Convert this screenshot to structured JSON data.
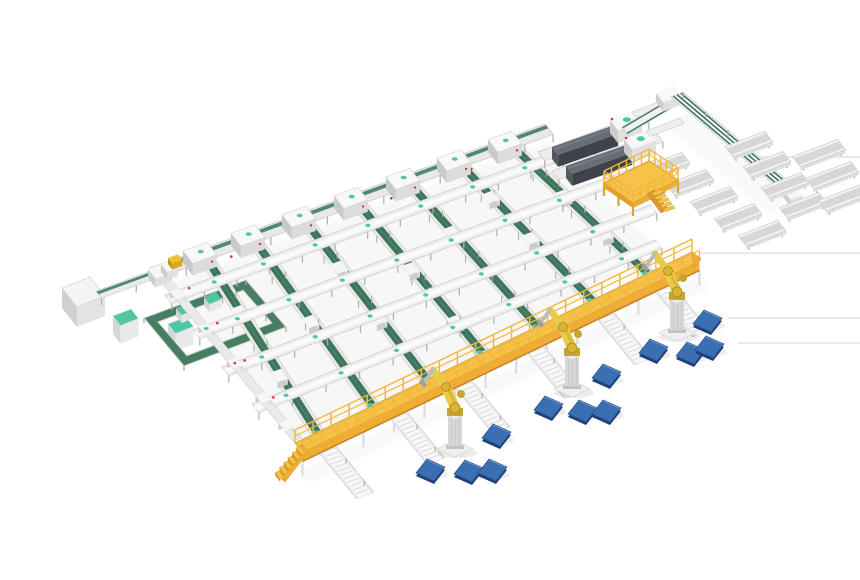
{
  "meta": {
    "alt": "Isometric 3D render of an automated parcel sorting and palletizing line on a white background"
  },
  "inventory": {
    "sorter_lanes": 7,
    "cross_conveyors": 4,
    "lane_head_units": 7,
    "tunnel_scanners": 2,
    "discharge_trays": 9,
    "stub_conveyors": 3,
    "palletizing_robots": 3,
    "pallets": 12,
    "maintenance_platforms": 1,
    "elevated_walkways": 1,
    "control_cabinets": 1,
    "tote_stations": 2,
    "loop_circuits": 1,
    "outfeed_spurs": 6
  },
  "palette": {
    "bg": "#ffffff",
    "frame": "#ececec",
    "frame_light": "#f8f8f8",
    "frame_mid": "#dadada",
    "frame_dark": "#c6c6c6",
    "leg": "#aeaeae",
    "belt": "#3c745c",
    "belt_edge": "#2f6b51",
    "belt_light": "#578f74",
    "belt_stripe": "#4e8a6e",
    "teal": "#4fc7a4",
    "loop": "#457e61",
    "deck": "#f6c24a",
    "deck_mid": "#f0ad35",
    "deck_dark": "#d89c28",
    "deck_shadow": "#c97f1f",
    "rail": "#f2b83e",
    "robot": "#e9cb49",
    "robot_dark": "#c7a52e",
    "pedestal": "#d7d7d7",
    "pedestal_dark": "#c2c2c2",
    "hood": "#3f4248",
    "hood_mid": "#55595f",
    "hood_top": "#676d75",
    "pallet_top": "#3b6fb4",
    "pallet_front": "#27508c",
    "pallet_side": "#1e4077",
    "pallet_hi": "#7fa6d8",
    "red": "#cf3a2c",
    "yellow_small": "#f0c02e",
    "white": "#f4f4f4",
    "cab_front": "#e3e3e3",
    "cab_side": "#d0d0d0",
    "line_faint": "#e7e7e7",
    "shadow": "#8a8a8a"
  },
  "scene": {
    "canvas": {
      "w": 860,
      "h": 580
    },
    "axes": {
      "a": [
        0.94,
        -0.36
      ],
      "b": [
        0.62,
        0.79
      ]
    },
    "floor_lines": [
      [
        757,
        157,
        860
      ],
      [
        700,
        253,
        860
      ],
      [
        728,
        318,
        860
      ],
      [
        738,
        343,
        860
      ]
    ],
    "shadows": [
      {
        "pts": [
          [
            160,
            285
          ],
          [
            548,
            142
          ],
          [
            660,
            250
          ],
          [
            315,
            455
          ]
        ],
        "o": 0.07
      },
      {
        "pts": [
          [
            300,
            470
          ],
          [
            697,
            278
          ],
          [
            706,
            290
          ],
          [
            309,
            483
          ]
        ],
        "o": 0.06
      },
      {
        "pts": [
          [
            690,
            110
          ],
          [
            790,
            196
          ],
          [
            770,
            215
          ],
          [
            665,
            125
          ]
        ],
        "o": 0.05
      }
    ],
    "top_row": {
      "p1": [
        150,
        268
      ],
      "p2": [
        545,
        124
      ],
      "width": 13,
      "head_xs": [
        198,
        246,
        297,
        349,
        401,
        452,
        503
      ],
      "end_boxes": [
        [
          148,
          269,
          14,
          12,
          9
        ],
        [
          161,
          264,
          11,
          10,
          8
        ]
      ],
      "yellow_box": [
        168,
        258,
        10,
        7,
        6
      ],
      "red_dot_xs": [
        222,
        302,
        382,
        462
      ]
    },
    "lanes": {
      "width": 14,
      "belt_off": 3,
      "belt_w": 8,
      "ends": [
        [
          310,
          434
        ],
        [
          365,
          407
        ],
        [
          420,
          381
        ],
        [
          475,
          354
        ],
        [
          530,
          328
        ],
        [
          585,
          302
        ],
        [
          640,
          275
        ]
      ],
      "carriage_fracs": [
        [
          0.32,
          0.68
        ],
        [
          0.5
        ],
        [
          0.3,
          0.62
        ],
        [
          0.45,
          0.8
        ],
        [
          0.35
        ],
        [
          0.25,
          0.55
        ],
        [
          0.4,
          0.7
        ]
      ]
    },
    "cross_lines": [
      [
        [
          165,
          295
        ],
        [
          622,
          127
        ]
      ],
      [
        [
          193,
          330
        ],
        [
          655,
          160
        ]
      ],
      [
        [
          222,
          367
        ],
        [
          650,
          205
        ]
      ],
      [
        [
          252,
          404
        ],
        [
          655,
          240
        ]
      ]
    ],
    "left_boundary": {
      "p1": [
        150,
        268
      ],
      "p2": [
        293,
        441
      ],
      "width": 9,
      "box_fracs": [
        0.16,
        0.36,
        0.56,
        0.76,
        0.92
      ]
    },
    "left_area": {
      "cabinet": {
        "p1": [
          62,
          288
        ],
        "p2": [
          90,
          277
        ],
        "w": 24,
        "h": 20
      },
      "infeed": {
        "p1": [
          96,
          291
        ],
        "p2": [
          200,
          253
        ],
        "w": 9
      },
      "teal_cabinets": [
        {
          "p1": [
            113,
            316
          ],
          "p2": [
            131,
            309
          ],
          "w": 12,
          "h": 18
        },
        {
          "p1": [
            168,
            324
          ],
          "p2": [
            186,
            317
          ],
          "w": 12,
          "h": 18
        }
      ],
      "loop": {
        "outer": [
          [
            144,
            318
          ],
          [
            246,
            280
          ],
          [
            286,
            327
          ],
          [
            184,
            366
          ]
        ],
        "track": 9,
        "totes": [
          [
            [
              176,
              308
            ],
            [
              188,
              303
            ]
          ],
          [
            [
              204,
              297
            ],
            [
              216,
              292
            ]
          ]
        ]
      }
    },
    "scanners": {
      "offset": [
        14,
        19
      ],
      "base": [
        [
          538,
          152
        ],
        [
          642,
          114
        ]
      ],
      "base_w": 11,
      "hood": [
        [
          552,
          147
        ],
        [
          612,
          126
        ]
      ],
      "hood_w": 10,
      "hood_h": 12,
      "head": [
        [
          610,
          120
        ],
        [
          634,
          111
        ]
      ],
      "head_w": 13,
      "head_h": 13,
      "connector": [
        [
          632,
          112
        ],
        [
          666,
          99
        ]
      ]
    },
    "right_circuit": {
      "a_seg": [
        [
          622,
          127
        ],
        [
          668,
          100
        ]
      ],
      "a_w": 9,
      "turn_box": [
        [
          656,
          93
        ],
        [
          674,
          86
        ]
      ],
      "b_seg": [
        [
          671,
          97
        ],
        [
          783,
          192
        ]
      ],
      "b_w": 13,
      "end_box": [
        [
          783,
          190
        ],
        [
          795,
          186
        ]
      ],
      "trays_sw": [
        [
          662,
          160
        ],
        [
          686,
          177
        ],
        [
          710,
          194
        ],
        [
          734,
          211
        ],
        [
          758,
          228
        ]
      ],
      "trays_ne": [
        [
          745,
          139
        ],
        [
          763,
          159
        ],
        [
          781,
          180
        ],
        [
          799,
          200
        ]
      ],
      "stubs": [
        [
          815,
          148
        ],
        [
          828,
          170
        ],
        [
          841,
          192
        ]
      ],
      "tray_len": 42,
      "stub_len": 48
    },
    "platform": {
      "deck": [
        [
          604,
          183
        ],
        [
          649,
          161
        ],
        [
          678,
          180
        ],
        [
          633,
          203
        ]
      ],
      "under": [
        [
          616,
          190
        ],
        [
          649,
          172
        ],
        [
          666,
          186
        ],
        [
          633,
          202
        ]
      ],
      "rail_h": 12,
      "stairs_from": [
        652,
        193
      ],
      "stair_stringer": [
        [
          647,
          194
        ],
        [
          661,
          213
        ],
        [
          668,
          209
        ],
        [
          654,
          190
        ]
      ]
    },
    "walkway": {
      "p1": [
        295,
        443
      ],
      "p2": [
        692,
        252
      ],
      "deck_w": 12,
      "fascia_h": 9,
      "stair_stringer": [
        [
          302,
          444
        ],
        [
          277,
          475
        ],
        [
          285,
          482
        ],
        [
          308,
          452
        ]
      ],
      "stair_steps": 6,
      "end_cap": [
        [
          692,
          252
        ],
        [
          701,
          259
        ],
        [
          694,
          268
        ]
      ]
    },
    "spurs": {
      "xs": [
        312,
        383,
        448,
        520,
        590,
        648
      ],
      "len": 58,
      "width": 18,
      "dir": [
        0.63,
        0.77
      ]
    },
    "robots": [
      [
        455,
        449
      ],
      [
        572,
        389
      ],
      [
        677,
        333
      ]
    ],
    "pallets": [
      [
        430,
        470
      ],
      [
        468,
        471
      ],
      [
        492,
        470
      ],
      [
        496,
        435
      ],
      [
        548,
        407
      ],
      [
        582,
        411
      ],
      [
        606,
        411
      ],
      [
        606,
        375
      ],
      [
        653,
        350
      ],
      [
        690,
        353
      ],
      [
        709,
        347
      ],
      [
        707,
        321
      ]
    ]
  }
}
